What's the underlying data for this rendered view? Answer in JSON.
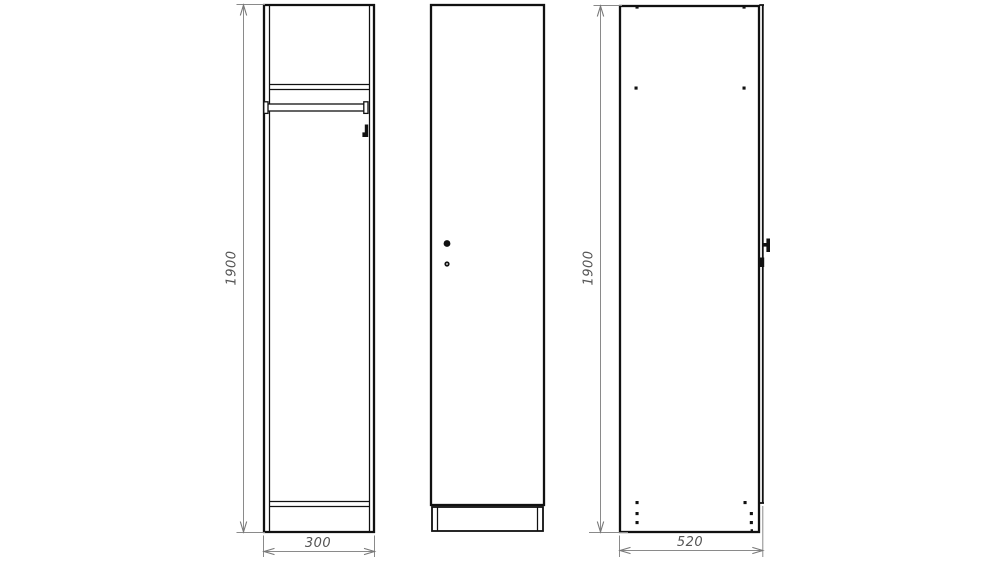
{
  "drawing": {
    "type": "cabinet-technical-drawing",
    "dimensions": {
      "front": {
        "height": "1900",
        "width": "300"
      },
      "side": {
        "height": "1900",
        "depth": "520"
      }
    },
    "colors": {
      "outline": "#111111",
      "dimension_line": "#8a8a8a",
      "dimension_text": "#555555",
      "background": "#ffffff"
    }
  }
}
